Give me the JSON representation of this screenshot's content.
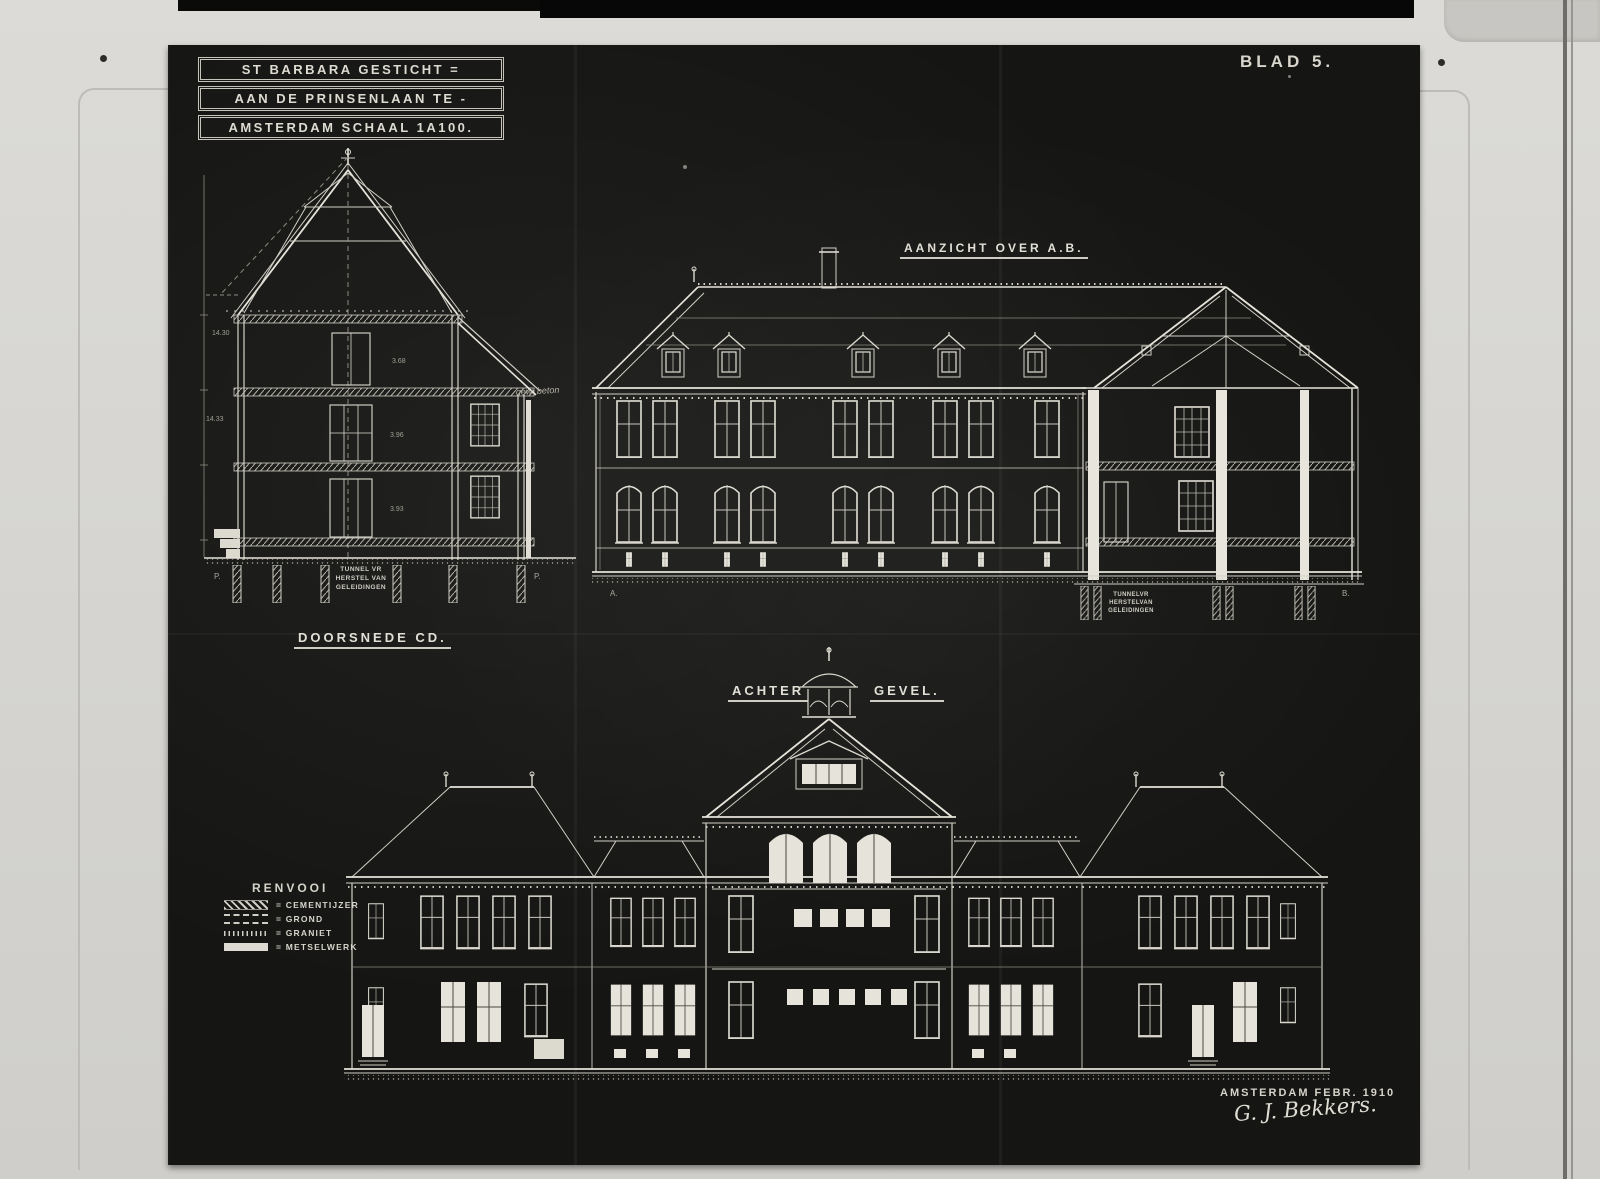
{
  "photo": {
    "blad_label": "BLAD 5.",
    "title_block": {
      "line1": "ST BARBARA GESTICHT =",
      "line2": "AAN DE PRINSENLAAN TE -",
      "line3": "AMSTERDAM SCHAAL 1A100."
    },
    "drawings": {
      "section": {
        "caption": "DOORSNEDE CD.",
        "tunnel_note": {
          "l1": "TUNNEL VR",
          "l2": "HERSTEL VAN",
          "l3": "GELEIDINGEN"
        },
        "dims": {
          "d1": "14.30",
          "d2": "14.33",
          "d3": "3.68",
          "d4": "3.96",
          "d5": "3.93"
        },
        "datum_left": "P.",
        "datum_right": "P.",
        "note_beton": "gew. beton"
      },
      "elevation_ab": {
        "caption": "AANZICHT OVER A.B.",
        "marker_left": "A.",
        "marker_right": "B.",
        "tunnel_note": {
          "l1": "TUNNELVR",
          "l2": "HERSTELVAN",
          "l3": "GELEIDINGEN"
        }
      },
      "rear": {
        "caption_left": "ACHTER",
        "caption_right": "GEVEL."
      }
    },
    "legend": {
      "title": "RENVOOI",
      "items": [
        {
          "label": "= CEMENTIJZER"
        },
        {
          "label": "= GROND"
        },
        {
          "label": "= GRANIET"
        },
        {
          "label": "= METSELWERK"
        }
      ]
    },
    "footer": {
      "place_date": "AMSTERDAM FEBR. 1910",
      "signature": "G. J. Bekkers."
    }
  }
}
